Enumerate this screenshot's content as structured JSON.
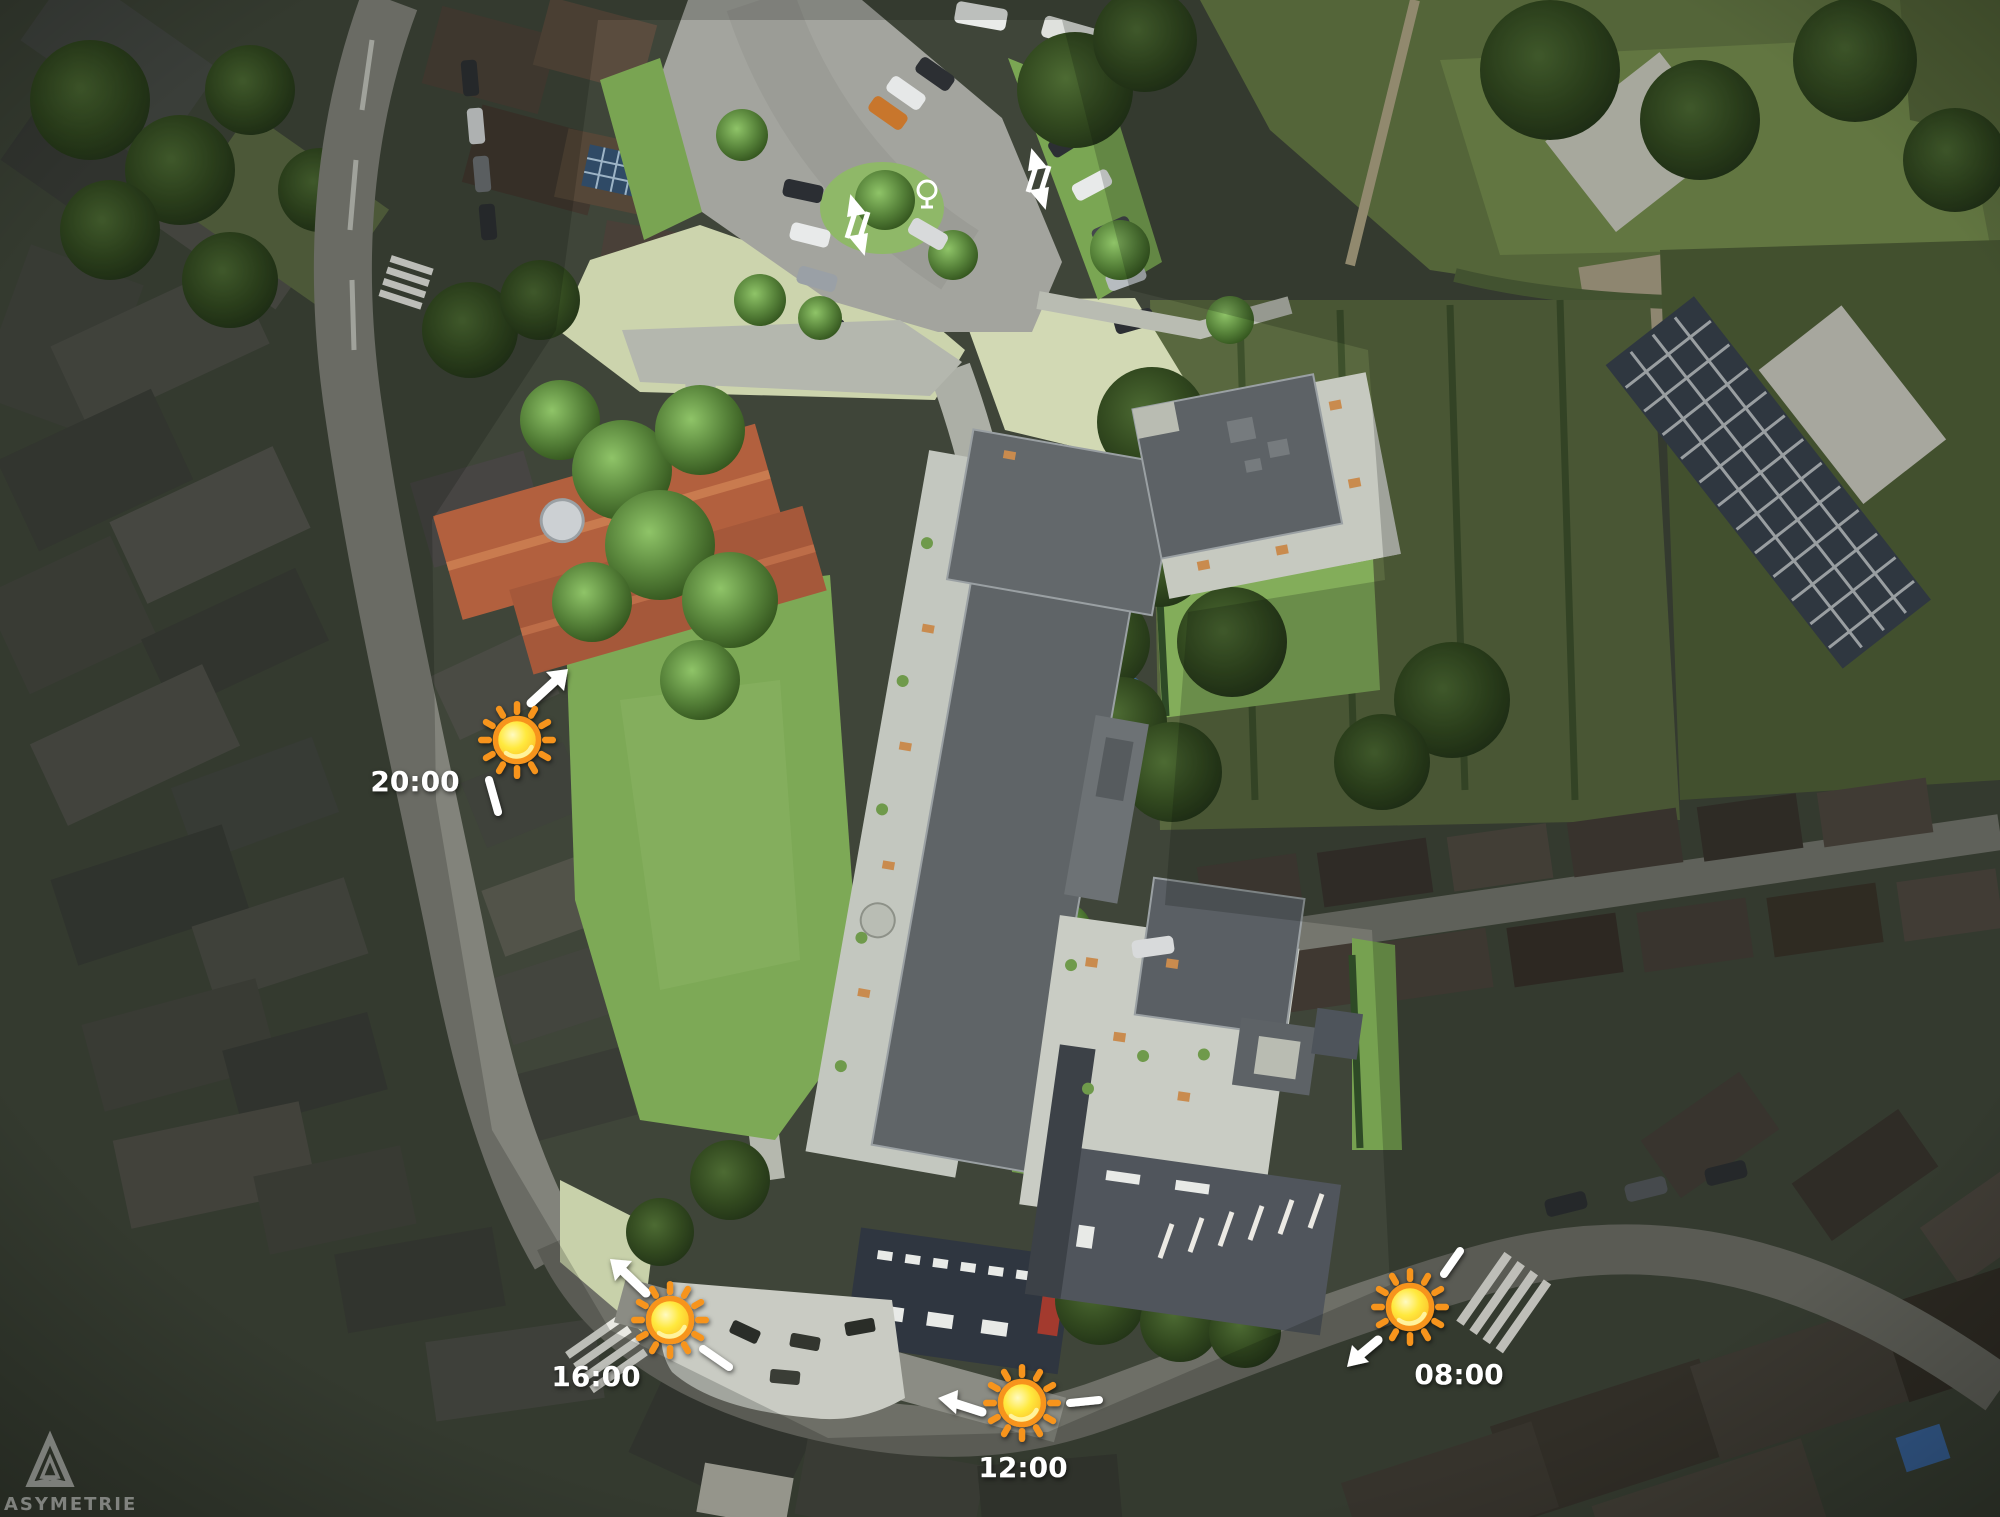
{
  "annotations": {
    "sun_path_markers": [
      {
        "time": "08:00",
        "arrow_direction": "south-west"
      },
      {
        "time": "12:00",
        "arrow_direction": "west"
      },
      {
        "time": "16:00",
        "arrow_direction": "north-west"
      },
      {
        "time": "20:00",
        "arrow_direction": "north-east"
      }
    ],
    "label_color": "#ffffff",
    "arrow_color": "#ffffff"
  },
  "sun_icon": {
    "ring_color": "#f7941d",
    "core_color": "#ffe93e",
    "ray_color": "#f7941d"
  },
  "watermark": {
    "brand": "ASYMETRIE",
    "logo": "penrose-triangle-icon",
    "color": "#c9c9c9"
  }
}
